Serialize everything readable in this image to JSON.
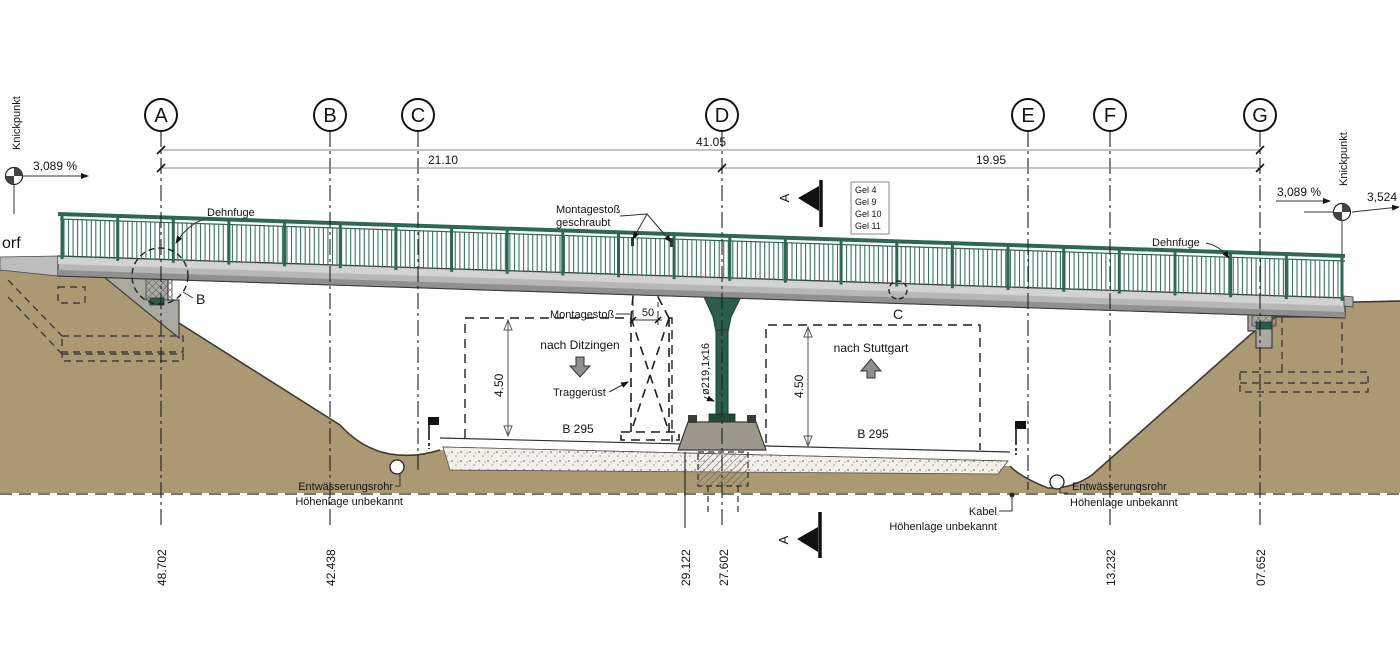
{
  "drawing": {
    "left": {
      "knickpunkt": "Knickpunkt",
      "grade": "3,089 %",
      "cut_word": "orf",
      "dehnfuge": "Dehnfuge",
      "detail_b": "B"
    },
    "right": {
      "knickpunkt": "Knickpunkt",
      "grade": "3,089 %",
      "grade2": "3,524",
      "dehnfuge": "Dehnfuge"
    },
    "axes": [
      {
        "label": "A",
        "station": "48.702"
      },
      {
        "label": "B",
        "station": "42.438"
      },
      {
        "label": "C",
        "station": ""
      },
      {
        "label": "D",
        "station": "27.602"
      },
      {
        "label": "E",
        "station": ""
      },
      {
        "label": "F",
        "station": "13.232"
      },
      {
        "label": "G",
        "station": "07.652"
      }
    ],
    "extra_station": "29.122",
    "dimensions": {
      "total": "41.05",
      "left_span": "21.10",
      "right_span": "19.95",
      "splice": "50",
      "clearance_left": "4.50",
      "clearance_right": "4.50",
      "pile_section": "ø219,1x16"
    },
    "labels": {
      "montage_splice_1": "Montagestoß",
      "montage_splice_2": "geschraubt",
      "montage": "Montagestoß",
      "to_ditzingen": "nach Ditzingen",
      "falsework": "Traggerüst",
      "road_left": "B 295",
      "road_right": "B 295",
      "to_stuttgart": "nach Stuttgart",
      "detail_c": "C",
      "section": "A"
    },
    "gel_box": [
      "Gel 4",
      "Gel 9",
      "Gel 10",
      "Gel 11"
    ],
    "drainage_left": {
      "line1": "Entwässerungsrohr",
      "line2": "Höhenlage unbekannt"
    },
    "drainage_right": {
      "line1": "Entwässerungsrohr",
      "line2": "Höhenlage unbekannt"
    },
    "cable": {
      "line1": "Kabel",
      "line2": "Höhenlage unbekannt"
    },
    "colors": {
      "soil": "#ab9974",
      "railing_green": "#2e6854",
      "pier_green": "#2b5d4b",
      "deck_gray": "#b7b7b7",
      "concrete": "#a9a9a2"
    }
  }
}
